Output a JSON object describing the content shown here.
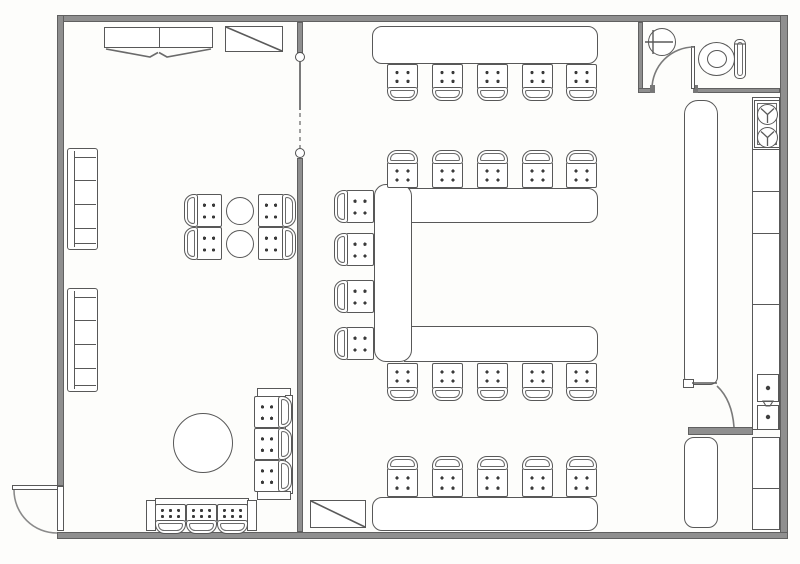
{
  "floorplan": {
    "type": "architectural-floor-plan",
    "description": "Scanned restaurant floor plan: left lounge room with wall benches, two-top round tables, large round table, settee and banquette; right dining room with U-shaped bar counter and stool rows; water closet top-right; kitchen service line along right wall",
    "colors": {
      "background": "#fdfdfb",
      "wall_fill": "#8f8f8f",
      "wall_edge": "#606060",
      "line": "#585858",
      "furniture_fill": "#ffffff",
      "tufting_dot": "#3a3a3a"
    },
    "inventory": {
      "bar_stools": 24,
      "lounge_chairs": 4,
      "settee_seats": 3,
      "banquette_seats": 3,
      "wall_benches": 2,
      "round_tables_small": 2,
      "round_tables_large": 1,
      "stair_symbols": 2,
      "wardrobe_cabinets": 1,
      "doors": [
        "entrance-door",
        "restroom-door",
        "kitchen-pass-door"
      ],
      "fixtures": [
        "wash-basin",
        "toilet",
        "range-burners",
        "prep-sink-units"
      ],
      "counters": [
        "north-counter",
        "u-shaped-bar",
        "south-counter",
        "service-counter",
        "kitchen-line-counter"
      ]
    },
    "chairs": [
      {
        "x": 387,
        "y": 64,
        "w": 31,
        "h": 37,
        "back": "bottom",
        "dots": 4,
        "kind": "bar-stool"
      },
      {
        "x": 432,
        "y": 64,
        "w": 31,
        "h": 37,
        "back": "bottom",
        "dots": 4,
        "kind": "bar-stool"
      },
      {
        "x": 477,
        "y": 64,
        "w": 31,
        "h": 37,
        "back": "bottom",
        "dots": 4,
        "kind": "bar-stool"
      },
      {
        "x": 522,
        "y": 64,
        "w": 31,
        "h": 37,
        "back": "bottom",
        "dots": 4,
        "kind": "bar-stool"
      },
      {
        "x": 566,
        "y": 64,
        "w": 31,
        "h": 37,
        "back": "bottom",
        "dots": 4,
        "kind": "bar-stool"
      },
      {
        "x": 387,
        "y": 150,
        "w": 31,
        "h": 38,
        "back": "top",
        "dots": 4,
        "kind": "bar-stool"
      },
      {
        "x": 432,
        "y": 150,
        "w": 31,
        "h": 38,
        "back": "top",
        "dots": 4,
        "kind": "bar-stool"
      },
      {
        "x": 477,
        "y": 150,
        "w": 31,
        "h": 38,
        "back": "top",
        "dots": 4,
        "kind": "bar-stool"
      },
      {
        "x": 522,
        "y": 150,
        "w": 31,
        "h": 38,
        "back": "top",
        "dots": 4,
        "kind": "bar-stool"
      },
      {
        "x": 566,
        "y": 150,
        "w": 31,
        "h": 38,
        "back": "top",
        "dots": 4,
        "kind": "bar-stool"
      },
      {
        "x": 334,
        "y": 190,
        "w": 40,
        "h": 33,
        "back": "left",
        "dots": 4,
        "kind": "bar-stool"
      },
      {
        "x": 334,
        "y": 233,
        "w": 40,
        "h": 33,
        "back": "left",
        "dots": 4,
        "kind": "bar-stool"
      },
      {
        "x": 334,
        "y": 280,
        "w": 40,
        "h": 33,
        "back": "left",
        "dots": 4,
        "kind": "bar-stool"
      },
      {
        "x": 334,
        "y": 327,
        "w": 40,
        "h": 33,
        "back": "left",
        "dots": 4,
        "kind": "bar-stool"
      },
      {
        "x": 387,
        "y": 363,
        "w": 31,
        "h": 38,
        "back": "bottom",
        "dots": 4,
        "kind": "bar-stool"
      },
      {
        "x": 432,
        "y": 363,
        "w": 31,
        "h": 38,
        "back": "bottom",
        "dots": 4,
        "kind": "bar-stool"
      },
      {
        "x": 477,
        "y": 363,
        "w": 31,
        "h": 38,
        "back": "bottom",
        "dots": 4,
        "kind": "bar-stool"
      },
      {
        "x": 522,
        "y": 363,
        "w": 31,
        "h": 38,
        "back": "bottom",
        "dots": 4,
        "kind": "bar-stool"
      },
      {
        "x": 566,
        "y": 363,
        "w": 31,
        "h": 38,
        "back": "bottom",
        "dots": 4,
        "kind": "bar-stool"
      },
      {
        "x": 387,
        "y": 456,
        "w": 31,
        "h": 41,
        "back": "top",
        "dots": 4,
        "kind": "bar-stool"
      },
      {
        "x": 432,
        "y": 456,
        "w": 31,
        "h": 41,
        "back": "top",
        "dots": 4,
        "kind": "bar-stool"
      },
      {
        "x": 477,
        "y": 456,
        "w": 31,
        "h": 41,
        "back": "top",
        "dots": 4,
        "kind": "bar-stool"
      },
      {
        "x": 522,
        "y": 456,
        "w": 31,
        "h": 41,
        "back": "top",
        "dots": 4,
        "kind": "bar-stool"
      },
      {
        "x": 566,
        "y": 456,
        "w": 31,
        "h": 41,
        "back": "top",
        "dots": 4,
        "kind": "bar-stool"
      },
      {
        "x": 184,
        "y": 194,
        "w": 38,
        "h": 33,
        "back": "left",
        "dots": 4,
        "kind": "lounge-chair"
      },
      {
        "x": 184,
        "y": 227,
        "w": 38,
        "h": 33,
        "back": "left",
        "dots": 4,
        "kind": "lounge-chair"
      },
      {
        "x": 258,
        "y": 194,
        "w": 38,
        "h": 33,
        "back": "right",
        "dots": 4,
        "kind": "lounge-chair"
      },
      {
        "x": 258,
        "y": 227,
        "w": 38,
        "h": 33,
        "back": "right",
        "dots": 4,
        "kind": "lounge-chair"
      },
      {
        "x": 155,
        "y": 504,
        "w": 31,
        "h": 30,
        "back": "bottom",
        "dots": 6,
        "kind": "settee-seat"
      },
      {
        "x": 186,
        "y": 504,
        "w": 31,
        "h": 30,
        "back": "bottom",
        "dots": 6,
        "kind": "settee-seat"
      },
      {
        "x": 217,
        "y": 504,
        "w": 31,
        "h": 30,
        "back": "bottom",
        "dots": 6,
        "kind": "settee-seat"
      },
      {
        "x": 254,
        "y": 396,
        "w": 38,
        "h": 32,
        "back": "right",
        "dots": 4,
        "kind": "banquette-seat"
      },
      {
        "x": 254,
        "y": 428,
        "w": 38,
        "h": 32,
        "back": "right",
        "dots": 4,
        "kind": "banquette-seat"
      },
      {
        "x": 254,
        "y": 460,
        "w": 38,
        "h": 32,
        "back": "right",
        "dots": 4,
        "kind": "banquette-seat"
      }
    ],
    "benches": [
      {
        "x": 67,
        "y": 148,
        "w": 31,
        "h": 102,
        "lines": [
          8,
          31,
          55,
          79,
          94
        ]
      },
      {
        "x": 67,
        "y": 288,
        "w": 31,
        "h": 104,
        "lines": [
          8,
          31,
          55,
          79,
          96
        ]
      }
    ],
    "tables": [
      {
        "x": 226,
        "y": 197,
        "d": 28,
        "kind": "round-table-small"
      },
      {
        "x": 226,
        "y": 230,
        "d": 28,
        "kind": "round-table-small"
      },
      {
        "x": 173,
        "y": 413,
        "d": 60,
        "kind": "round-table-large"
      }
    ]
  }
}
